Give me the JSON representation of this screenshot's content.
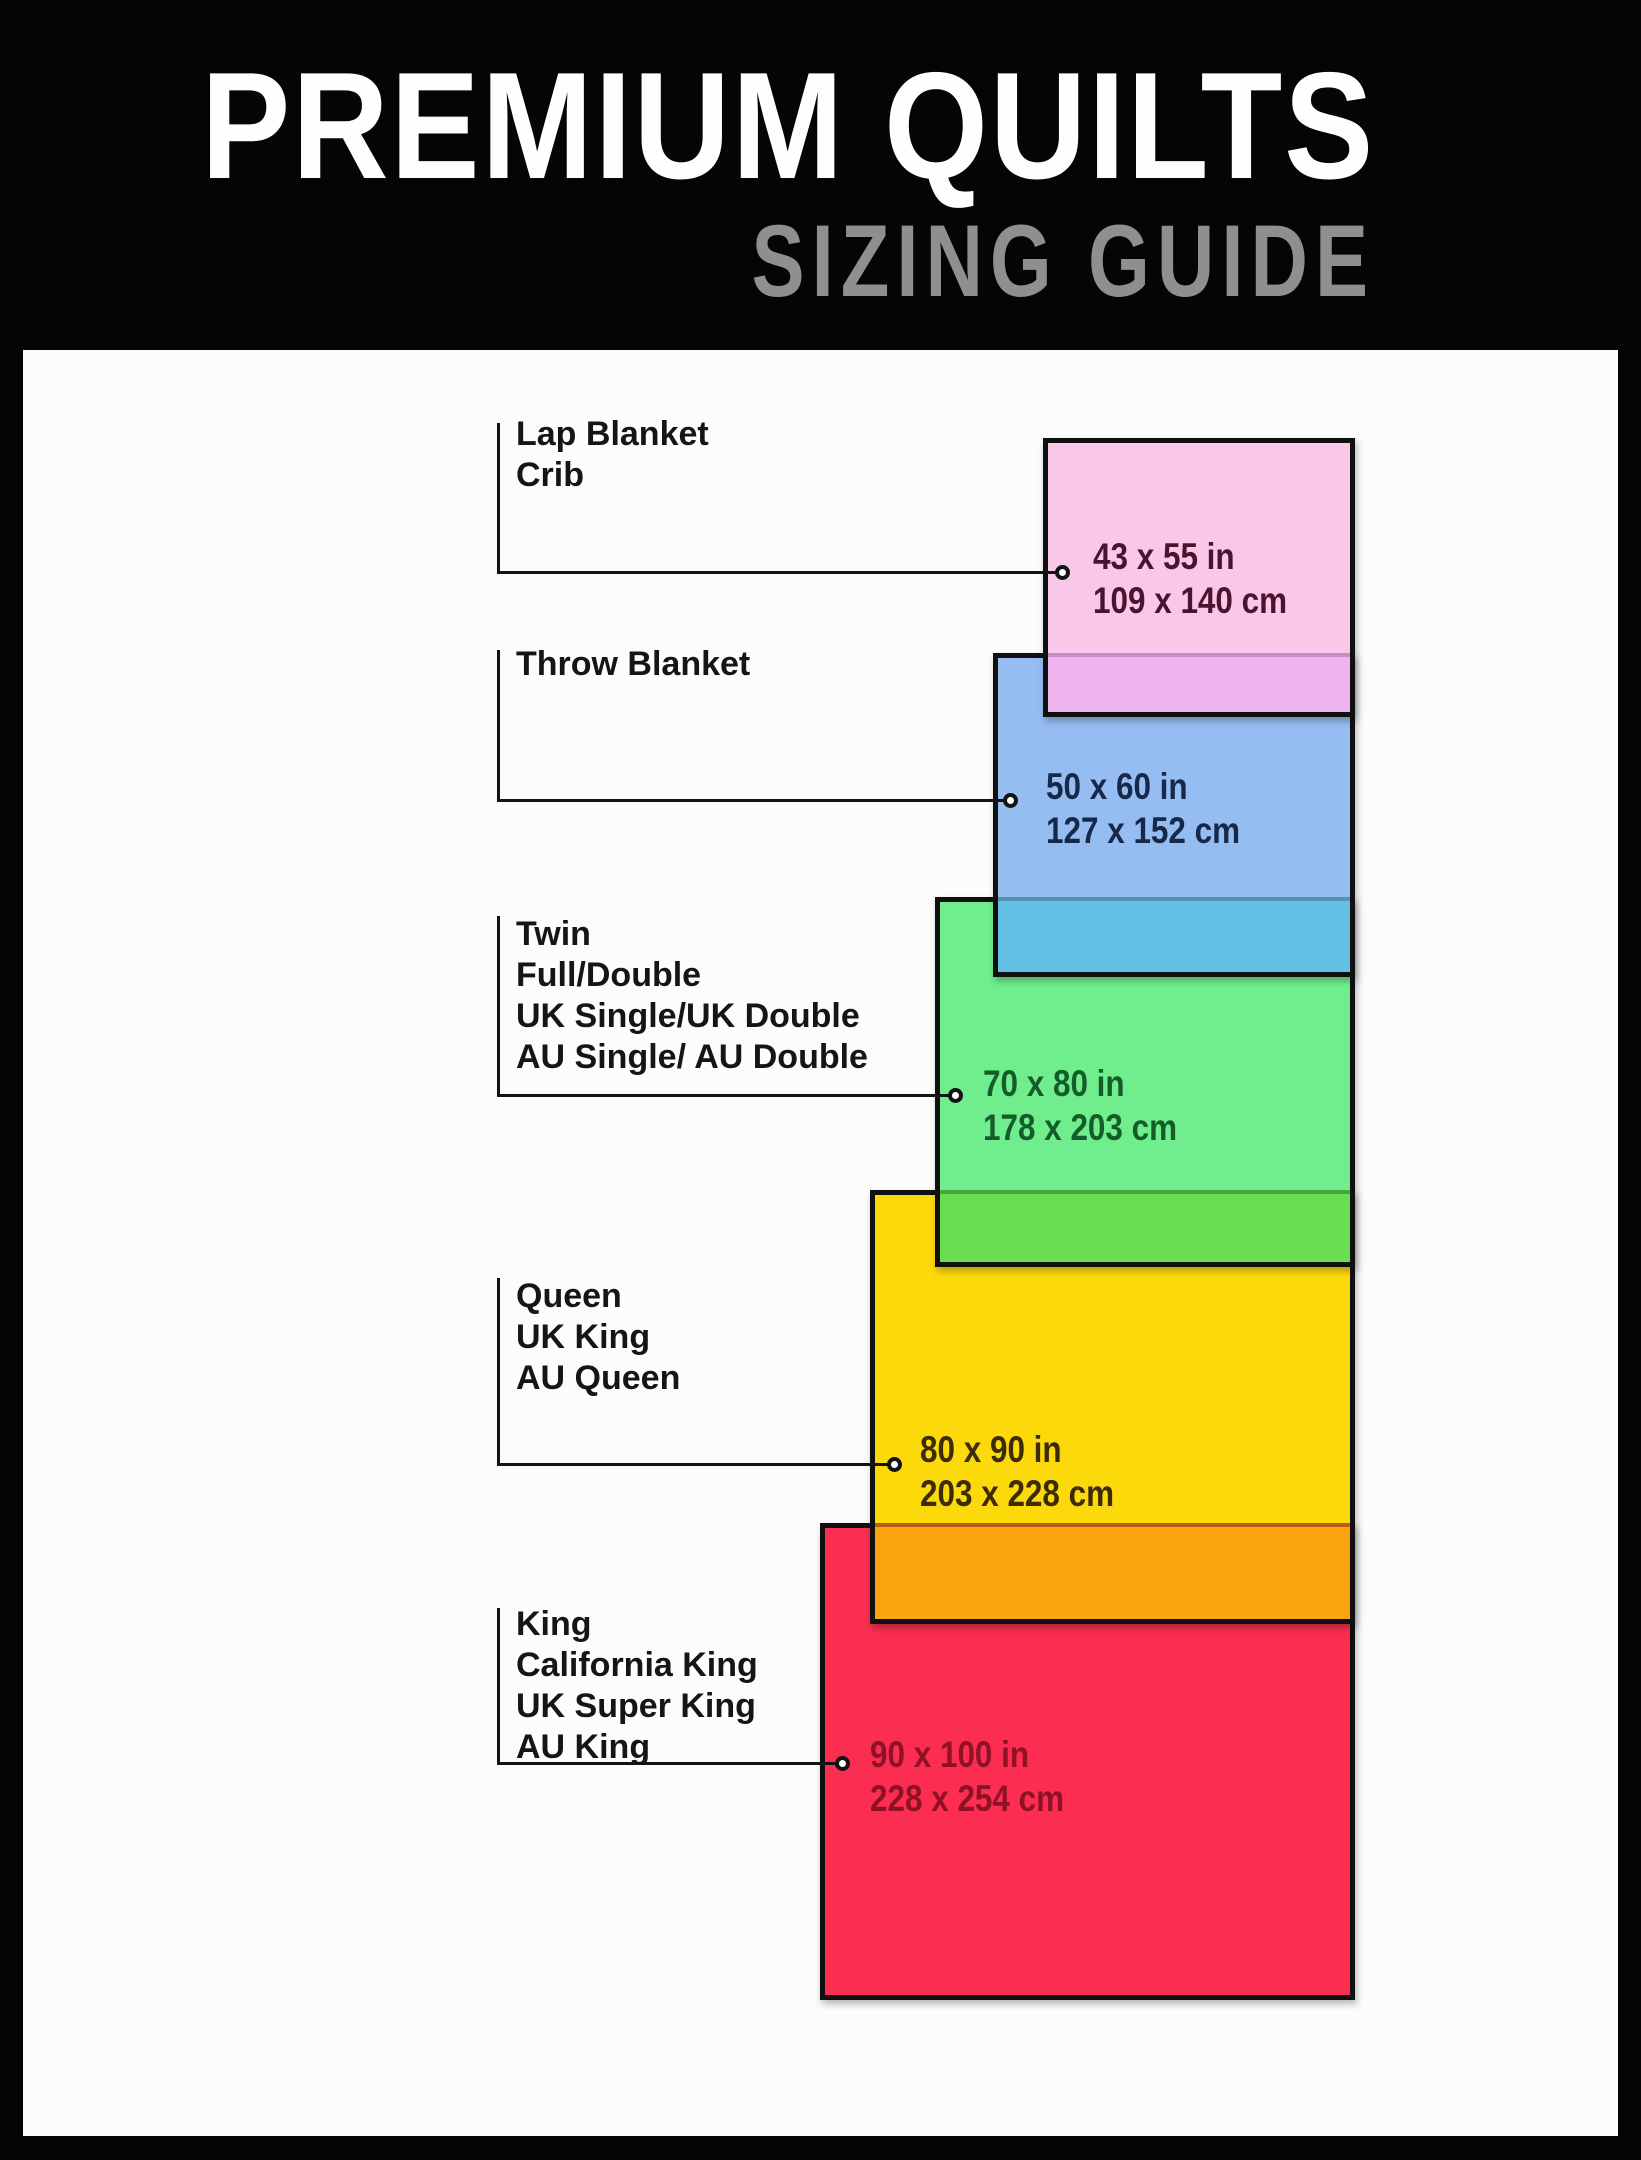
{
  "header": {
    "title": "PREMIUM QUILTS",
    "subtitle": "SIZING GUIDE"
  },
  "canvas": {
    "frame_color": "#050505",
    "panel_color": "#FCFCFC",
    "line_color": "#131313"
  },
  "sizes": [
    {
      "names": [
        "Lap Blanket",
        "Crib"
      ],
      "inches": "43 x 55 in",
      "cm": "109 x 140 cm",
      "colors": {
        "fill": "#F9C7E8",
        "dim_text": "#4C132F"
      }
    },
    {
      "names": [
        "Throw Blanket"
      ],
      "inches": "50 x 60 in",
      "cm": "127 x 152 cm",
      "colors": {
        "fill": "#96BDF2",
        "dim_text": "#17294A"
      }
    },
    {
      "names": [
        "Twin",
        "Full/Double",
        "UK Single/UK Double",
        "AU Single/ AU Double"
      ],
      "inches": "70 x 80 in",
      "cm": "178 x 203 cm",
      "colors": {
        "fill": "#70EE8D",
        "dim_text": "#155C2B"
      }
    },
    {
      "names": [
        "Queen",
        "UK King",
        "AU Queen"
      ],
      "inches": "80 x 90 in",
      "cm": "203 x 228 cm",
      "colors": {
        "fill": "#FCD90B",
        "dim_text": "#3B2B06"
      }
    },
    {
      "names": [
        "King",
        "California King",
        "UK Super King",
        "AU King"
      ],
      "inches": "90 x 100 in",
      "cm": "228 x 254 cm",
      "colors": {
        "fill": "#FB2E51",
        "dim_text": "#8F1125"
      }
    }
  ],
  "overlaps": [
    {
      "between": "lap-crib over throw",
      "color": "#EDB4EE",
      "line": "#C38FC4"
    },
    {
      "between": "throw over twin",
      "color": "#63BFE3",
      "line": "#4E96AE"
    },
    {
      "between": "twin over queen",
      "color": "#69DE50",
      "line": "#46A73E"
    },
    {
      "between": "queen over king",
      "color": "#FAA40F",
      "line": "#C05A17"
    }
  ]
}
